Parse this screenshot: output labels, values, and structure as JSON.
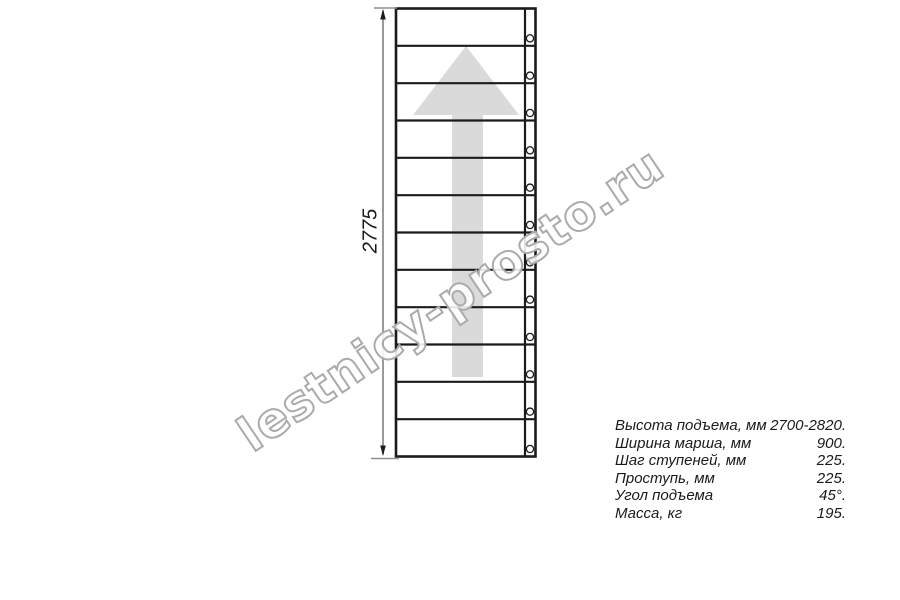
{
  "theme": {
    "background": "#ffffff",
    "line_color": "#1b1b1b",
    "dimension_color": "#8f8f8f",
    "arrow_fill": "#dadada",
    "watermark_stroke": "#ababab",
    "text_color": "#1a1a1a"
  },
  "watermark": {
    "text": "lestnicy-prosto.ru"
  },
  "drawing": {
    "type": "staircase-top-view",
    "steps": 12,
    "direction_arrow": "up",
    "dimension_label": "2775"
  },
  "specs": [
    {
      "label": "Высота подъема, мм",
      "value": "2700-2820."
    },
    {
      "label": "Ширина марша, мм",
      "value": "900."
    },
    {
      "label": "Шаг ступеней, мм",
      "value": "225."
    },
    {
      "label": "Проступь, мм",
      "value": "225."
    },
    {
      "label": "Угол подъема",
      "value": "45°."
    },
    {
      "label": "Масса, кг",
      "value": "195."
    }
  ]
}
